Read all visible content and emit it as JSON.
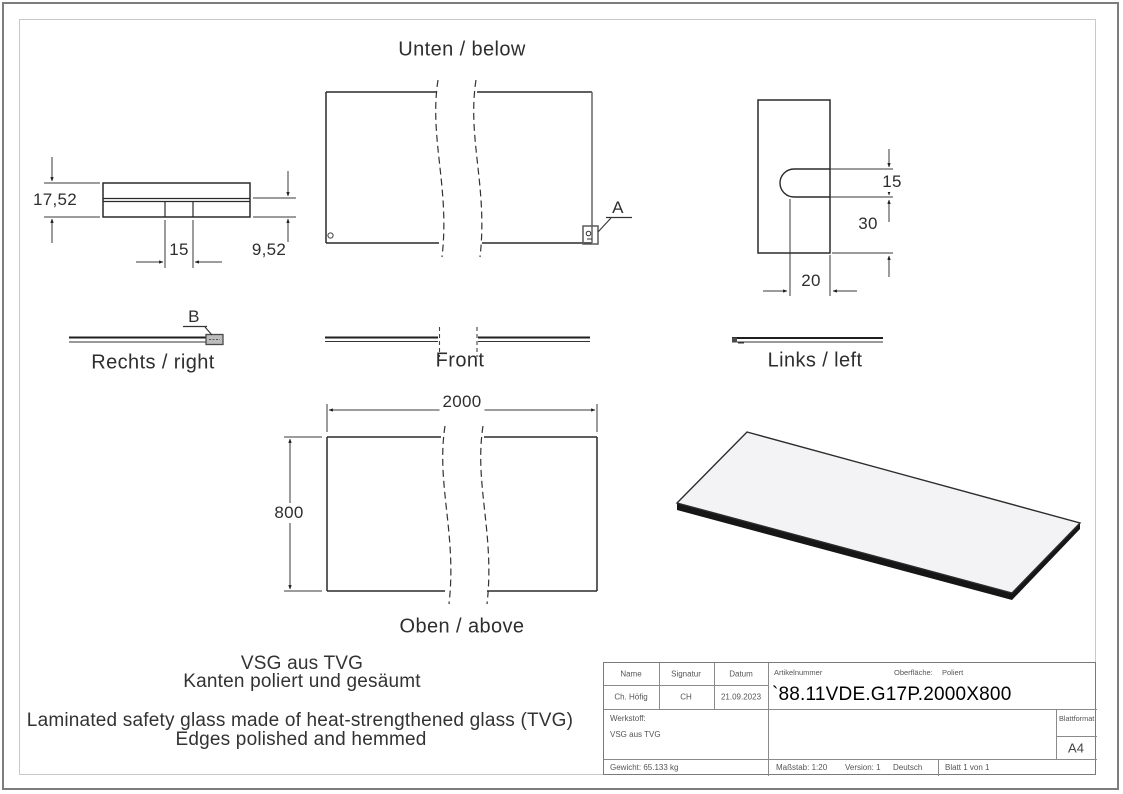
{
  "sheet": {
    "views": {
      "bottom_label": "Unten / below",
      "right_label": "Rechts / right",
      "front_label": "Front",
      "left_label": "Links / left",
      "top_label": "Oben / above"
    },
    "callouts": {
      "a": "A",
      "b": "B"
    },
    "dimensions": {
      "thickness_total": "17,52",
      "slot_width_side": "15",
      "pane_thickness": "9,52",
      "slot_width": "15",
      "slot_edge_offset": "30",
      "slot_depth": "20",
      "length": "2000",
      "width": "800"
    },
    "notes": {
      "de_line1": "VSG aus TVG",
      "de_line2": "Kanten poliert und gesäumt",
      "en_line1": "Laminated safety glass made of heat-strengthened glass (TVG)",
      "en_line2": "Edges polished and hemmed"
    },
    "title_block": {
      "name_label": "Name",
      "signatur_label": "Signatur",
      "datum_label": "Datum",
      "name_value": "Ch. Höfig",
      "signatur_value": "CH",
      "datum_value": "21.09.2023",
      "artikelnummer_label": "Artikelnummer",
      "oberflaeche_label": "Oberfläche:",
      "oberflaeche_value": "Poliert",
      "artikelnummer_value": "`88.11VDE.G17P.2000X800",
      "werkstoff_label": "Werkstoff:",
      "werkstoff_value": "VSG aus TVG",
      "blattformat_label": "Blattformat",
      "blattformat_value": "A4",
      "gewicht": "Gewicht: 65.133 kg",
      "massstab": "Maßstab: 1:20",
      "version": "Version: 1",
      "sprache": "Deutsch",
      "blatt": "Blatt 1 von 1"
    }
  }
}
